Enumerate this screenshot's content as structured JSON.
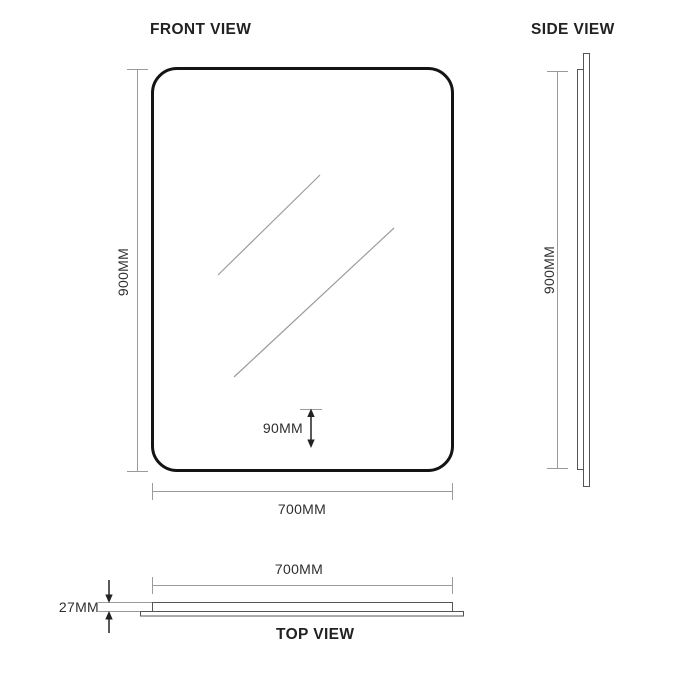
{
  "front_view": {
    "title": "FRONT VIEW",
    "height_label": "900MM",
    "width_label": "700MM",
    "inset_label": "90MM"
  },
  "side_view": {
    "title": "SIDE VIEW",
    "height_label": "900MM"
  },
  "top_view": {
    "title": "TOP VIEW",
    "width_label": "700MM",
    "depth_label": "27MM"
  },
  "colors": {
    "mirror_outline": "#141414",
    "profile_stroke": "#555555",
    "dimension_line": "#9b9b9b",
    "glare_line": "#9c9c9c",
    "arrow": "#222222",
    "text": "#2e2e2e",
    "title_text": "#222222",
    "background": "#ffffff"
  }
}
